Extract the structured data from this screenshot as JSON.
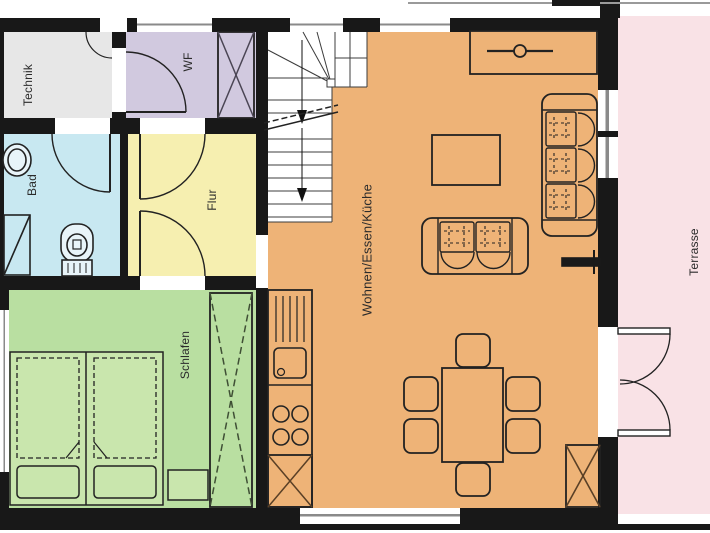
{
  "rooms": {
    "technik": {
      "label": "Technik",
      "color": "#e7e7e7"
    },
    "wf": {
      "label": "WF",
      "color": "#d1c9df"
    },
    "bad": {
      "label": "Bad",
      "color": "#c8e8f1"
    },
    "flur": {
      "label": "Flur",
      "color": "#f6efb0"
    },
    "schlafen": {
      "label": "Schlafen",
      "color": "#b9dfa1"
    },
    "wohnen": {
      "label": "Wohnen/Essen/Küche",
      "color": "#eeb377"
    },
    "terrasse": {
      "label": "Terrasse",
      "color": "#f9e2e6"
    }
  },
  "palette": {
    "wall": "#181818",
    "line": "#2a2a2a",
    "glass": "#8a8a8a",
    "stairs": "#ffffff",
    "bed_fill": "#c9e6ad",
    "fixture_fill": "#e8f4f9",
    "wood_cross": "#5a4026"
  },
  "symbols": [
    "staircase",
    "entrance-door",
    "door-swing",
    "window",
    "french-door",
    "double-bed",
    "wardrobe",
    "nightstand",
    "washbasin",
    "shower",
    "toilet",
    "kitchen-counter",
    "sink",
    "cooktop",
    "tall-unit-shaft",
    "dining-table",
    "chair",
    "sofa-3-seat",
    "sofa-2-seat",
    "coffee-table",
    "sideboard-stove",
    "radiator",
    "shaft"
  ]
}
